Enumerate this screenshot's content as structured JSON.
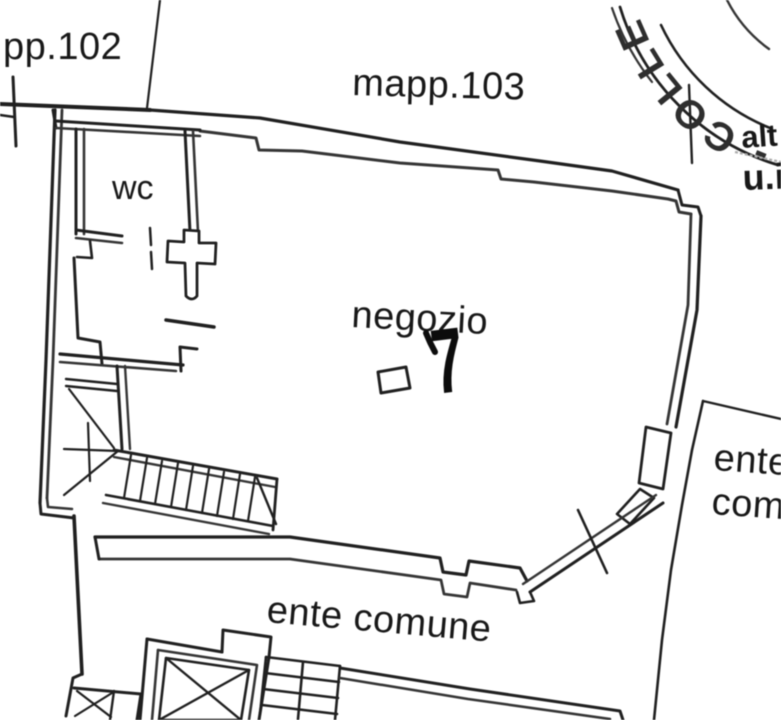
{
  "page": {
    "background": "#ffffff",
    "ink": "#262626",
    "faint_ink": "#a9a9a9"
  },
  "plan": {
    "labels": {
      "parcel_left": "pp.102",
      "parcel_top": "mapp.103",
      "wc_room": "wc",
      "main_room": "negozio",
      "unit_number": "7",
      "common_area_bottom": "ente comune",
      "common_area_right_line1": "ente",
      "common_area_right_line2": "com",
      "right_edge_note_line1": "alt",
      "right_edge_note_line2": "u.i"
    },
    "stamp": {
      "arc_text": "- COLLE"
    }
  }
}
